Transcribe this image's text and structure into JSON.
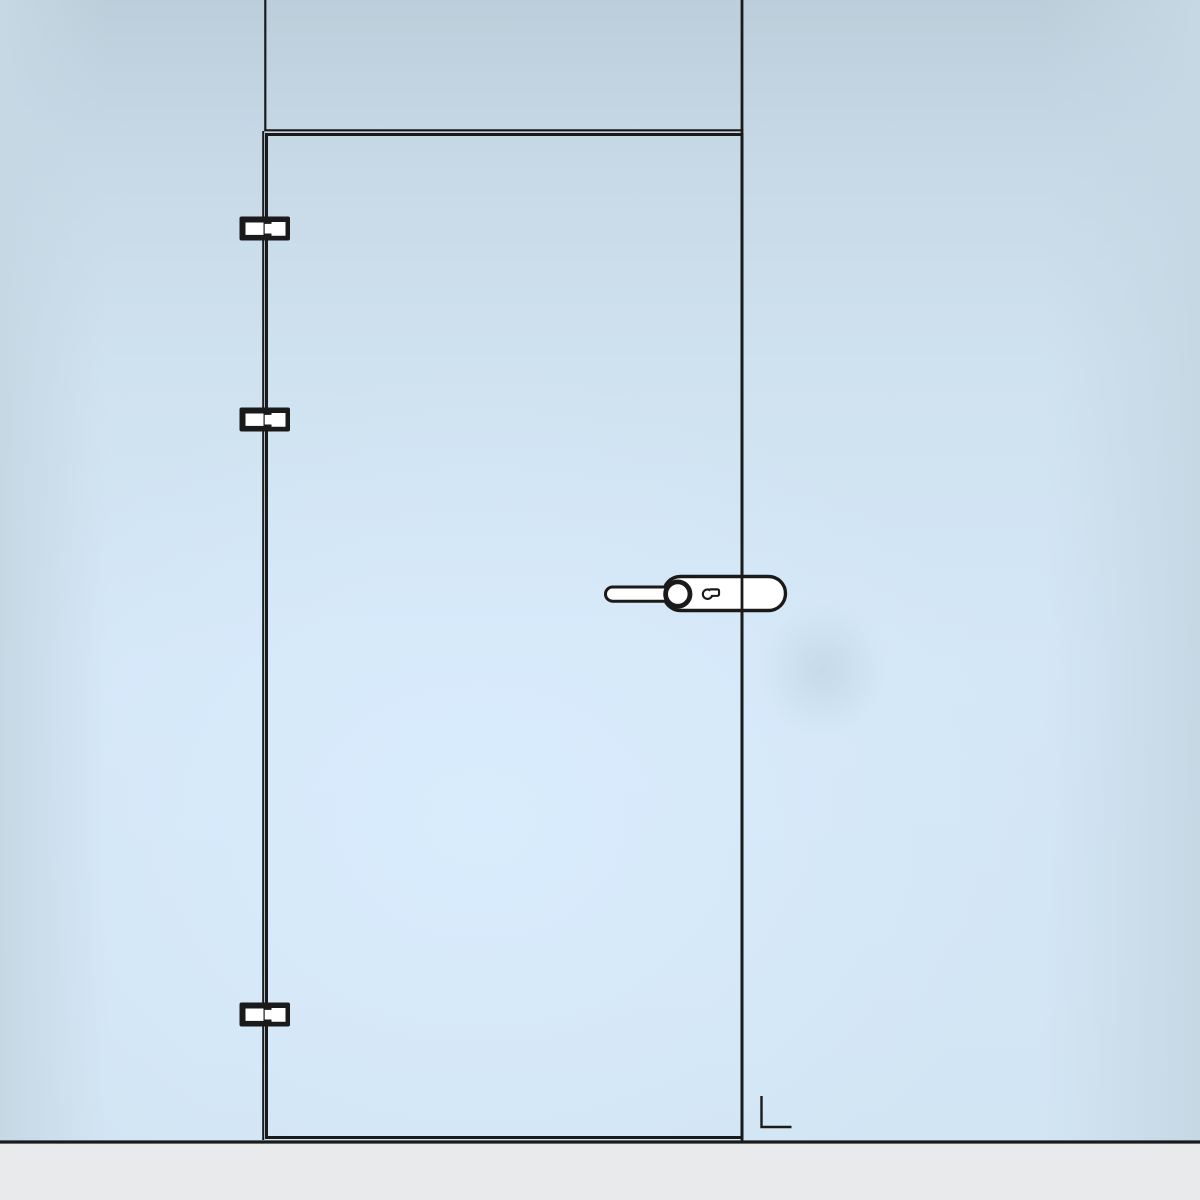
{
  "scene": {
    "description": "Front-view line illustration of a frameless glass swing door set in a glass wall with a transom panel above, three offset hinges on the left edge, a lever handle with keyhole backplate on the right edge, an L-shaped floor marker near the lower right corner, and a gray floor strip below",
    "door": {
      "hinge_side": "left",
      "handle_side": "right",
      "hinge_count": 3
    },
    "components": {
      "transom_panel": "glass panel above door",
      "hinge_top": "top-hinge",
      "hinge_middle": "middle-hinge",
      "hinge_bottom": "bottom-hinge",
      "handle": "lever-handle-with-keyhole-backplate",
      "floor_marker": "L-shaped corner mark"
    }
  },
  "colors": {
    "line": "#1a1a1a",
    "hardware_fill": "#ffffff",
    "floor": "#e9eaec",
    "bg_top": "#bdcedb",
    "bg_side": "#c6d8e4",
    "bg_highlight": "#d9ecfd",
    "smudge": "#aec4d3"
  }
}
